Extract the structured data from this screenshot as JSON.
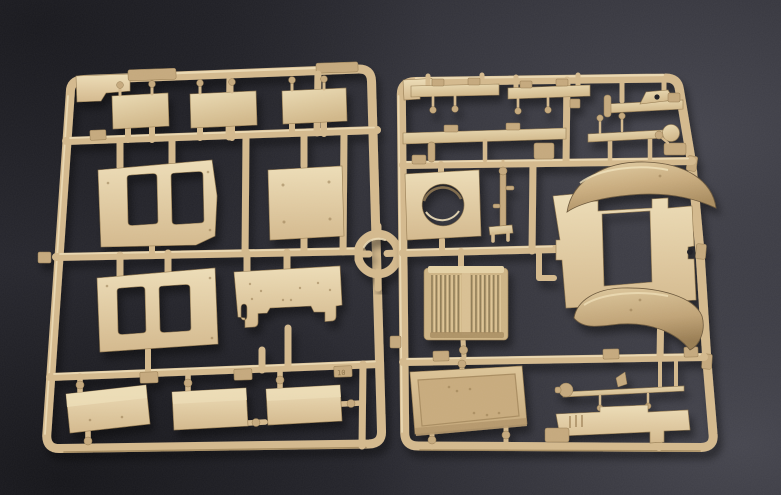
{
  "scene": {
    "type": "photograph",
    "subject": "Two tan injection-molded plastic model kit sprues (parts frames) lying on a dark gray surface, joined by a circular runner ring",
    "palette": {
      "bg_dark": "#17171c",
      "bg_mid": "#26262d",
      "bg_light": "#484851",
      "plastic": "#d3b88c",
      "plastic_light": "#ecdcb6",
      "plastic_mid": "#c4a87c",
      "plastic_dark": "#93794f",
      "plastic_deep": "#6b573a",
      "fender_hi": "#e3cfa5",
      "fender_lo": "#a98c5f",
      "hole_dark": "#1c1c21"
    },
    "sprues": [
      {
        "id": "left",
        "label": "left sprue",
        "tag_label": "10",
        "parts": [
          "small rectangular plate x3 (top row)",
          "hull side panel with two hatch openings x2",
          "flat square plate with four pin holes",
          "notched bulkhead panel with arched cutout",
          "flat bed plate x3 (bottom row)"
        ]
      },
      {
        "id": "right",
        "label": "right sprue",
        "tag_label": "",
        "parts": [
          "angle rail with hanging pegs x2",
          "mount bracket with hump",
          "long flat rail",
          "linkage rod with end disc",
          "turret-ring plate with circular opening",
          "steering column rod",
          "twin-fender assembly with rectangular cutout",
          "radiator grille with vertical slats",
          "shallow cargo tray",
          "axle rod with end knob",
          "stepped running-board plate",
          "clamp block"
        ]
      }
    ],
    "connector": "circular runner ring between the sprues"
  }
}
